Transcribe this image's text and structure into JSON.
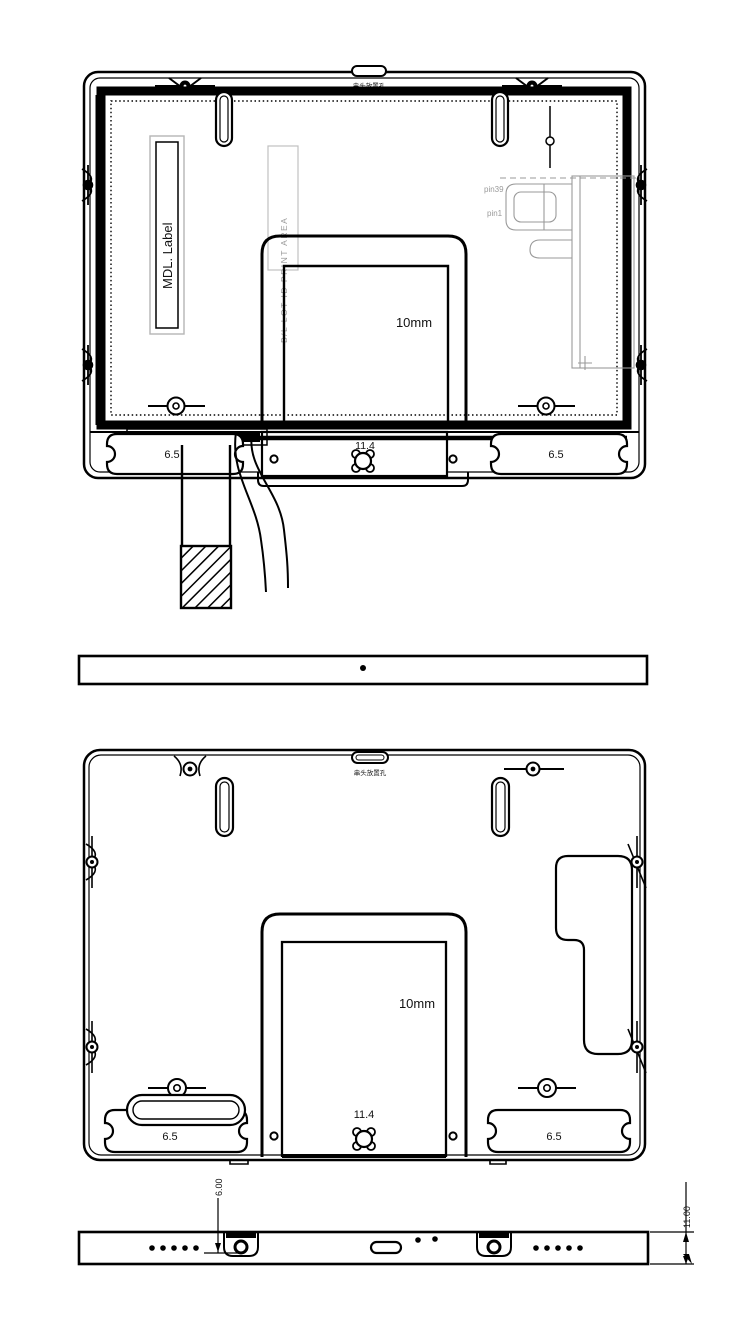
{
  "drawing": {
    "view_rear_fpc": {
      "top_note": "串头放置孔",
      "mdl_label": "MDL. Label",
      "lot_area": "B/L LOT ID PRINT AREA",
      "pin39": "pin39",
      "pin1": "pin1",
      "depth": "10mm",
      "dim_left": "6.5",
      "dim_center": "11.4",
      "dim_right": "6.5"
    },
    "view_rear": {
      "top_note": "串头放置孔",
      "depth": "10mm",
      "dim_left": "6.5",
      "dim_center": "11.4",
      "dim_right": "6.5"
    },
    "view_bottom": {
      "dim_boss": "6.00",
      "dim_thickness": "11.00"
    },
    "colors": {
      "line": "#000000",
      "light_gray": "#9a9a9a",
      "bracket_gray": "#b5b5b5"
    }
  }
}
